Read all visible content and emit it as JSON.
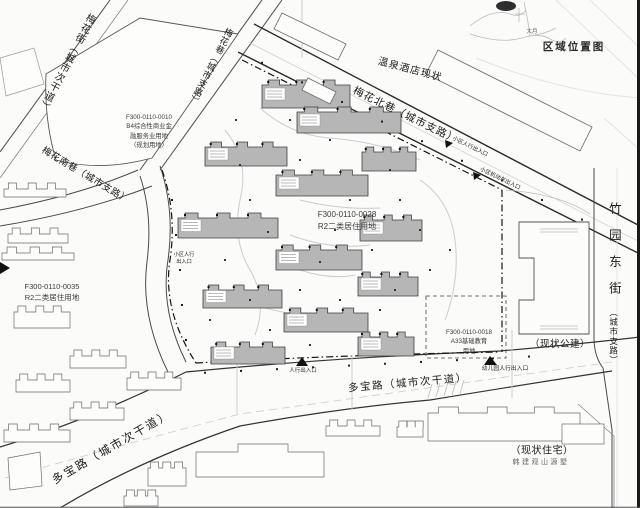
{
  "inset_map": {
    "caption": "区域位置图",
    "place_label": "大月"
  },
  "roads": {
    "meihua_street": "梅花街（城市次干道）",
    "meihua_lane": "梅花巷（城市支路）",
    "meihua_south_lane": "梅花南巷（城市支路）",
    "meihua_north_lane": "梅花北巷（城市支路）",
    "zhuyuan_east_street": "竹园东街",
    "zhuyuan_east_street_class": "（城市支路）",
    "duobao_road_sw": "多宝路（城市次干道）",
    "duobao_road_e": "多宝路（城市次干道）"
  },
  "parcels": [
    {
      "code": "F300-0110-0010",
      "use": [
        "B4综合性商业金",
        "融服务业用地",
        "（规划用地）"
      ]
    },
    {
      "code": "F300-0110-0028",
      "use": [
        "R2二类居住用地"
      ]
    },
    {
      "code": "F300-0110-0035",
      "use": [
        "R2二类居住用地"
      ]
    },
    {
      "code": "F300-0110-0018",
      "use": [
        "A33基础教育",
        "用地"
      ]
    }
  ],
  "annotations": {
    "hotel_status": "温泉酒店现状",
    "existing_public_building": "（现状公建）",
    "existing_residence": "（现状住宅）",
    "residence_project_name": "韩建观山源墅",
    "kindergarten_ped_entrance": "幼儿园人行出入口",
    "community_ped_entrance_north": "小区人行出入口",
    "community_vehicle_entrance": "小区机动车出入口",
    "community_ped_entrance_west": "小区人行出入口",
    "ped_entrance_south": "人行出入口"
  }
}
